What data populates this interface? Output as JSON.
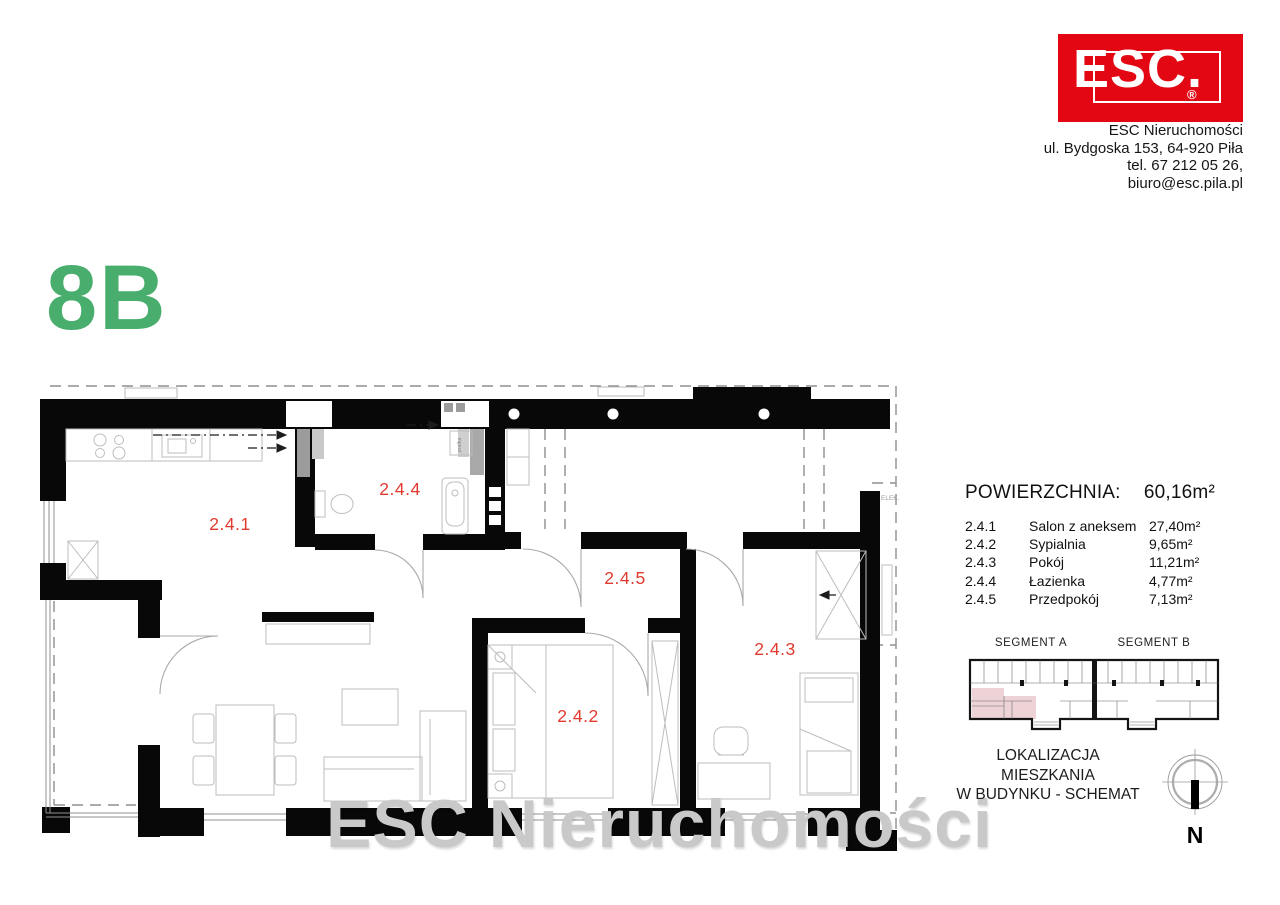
{
  "brand": {
    "logo_text": "ESC",
    "logo_suffix": ".",
    "registered_mark": "®",
    "colors": {
      "logo_red": "#e30613",
      "unit_green": "#49ae6d",
      "room_label_red": "#e13a2e",
      "highlight_pink": "#eed3d6"
    },
    "address_lines": [
      "ESC Nieruchomości",
      "ul. Bydgoska 153, 64-920 Piła",
      "tel. 67 212 05 26,",
      "biuro@esc.pila.pl"
    ]
  },
  "unit": {
    "label": "8B"
  },
  "watermark": {
    "text": "ESC Nieruchomości"
  },
  "plan": {
    "room_labels": [
      {
        "id": "2.4.1"
      },
      {
        "id": "2.4.2"
      },
      {
        "id": "2.4.3"
      },
      {
        "id": "2.4.4"
      },
      {
        "id": "2.4.5"
      }
    ],
    "annotations": {
      "pralka": "pralka",
      "elek": "ELEK."
    }
  },
  "areas": {
    "title": "POWIERZCHNIA:",
    "total_area": "60,16m²",
    "rows": [
      {
        "no": "2.4.1",
        "name": "Salon z aneksem",
        "area": "27,40m²"
      },
      {
        "no": "2.4.2",
        "name": "Sypialnia",
        "area": "9,65m²"
      },
      {
        "no": "2.4.3",
        "name": "Pokój",
        "area": "11,21m²"
      },
      {
        "no": "2.4.4",
        "name": "Łazienka",
        "area": "4,77m²"
      },
      {
        "no": "2.4.5",
        "name": "Przedpokój",
        "area": "7,13m²"
      }
    ]
  },
  "location_schematic": {
    "segment_a_label": "SEGMENT A",
    "segment_b_label": "SEGMENT B",
    "caption_line1": "LOKALIZACJA MIESZKANIA",
    "caption_line2": "W BUDYNKU - SCHEMAT"
  },
  "compass": {
    "north_label": "N"
  }
}
